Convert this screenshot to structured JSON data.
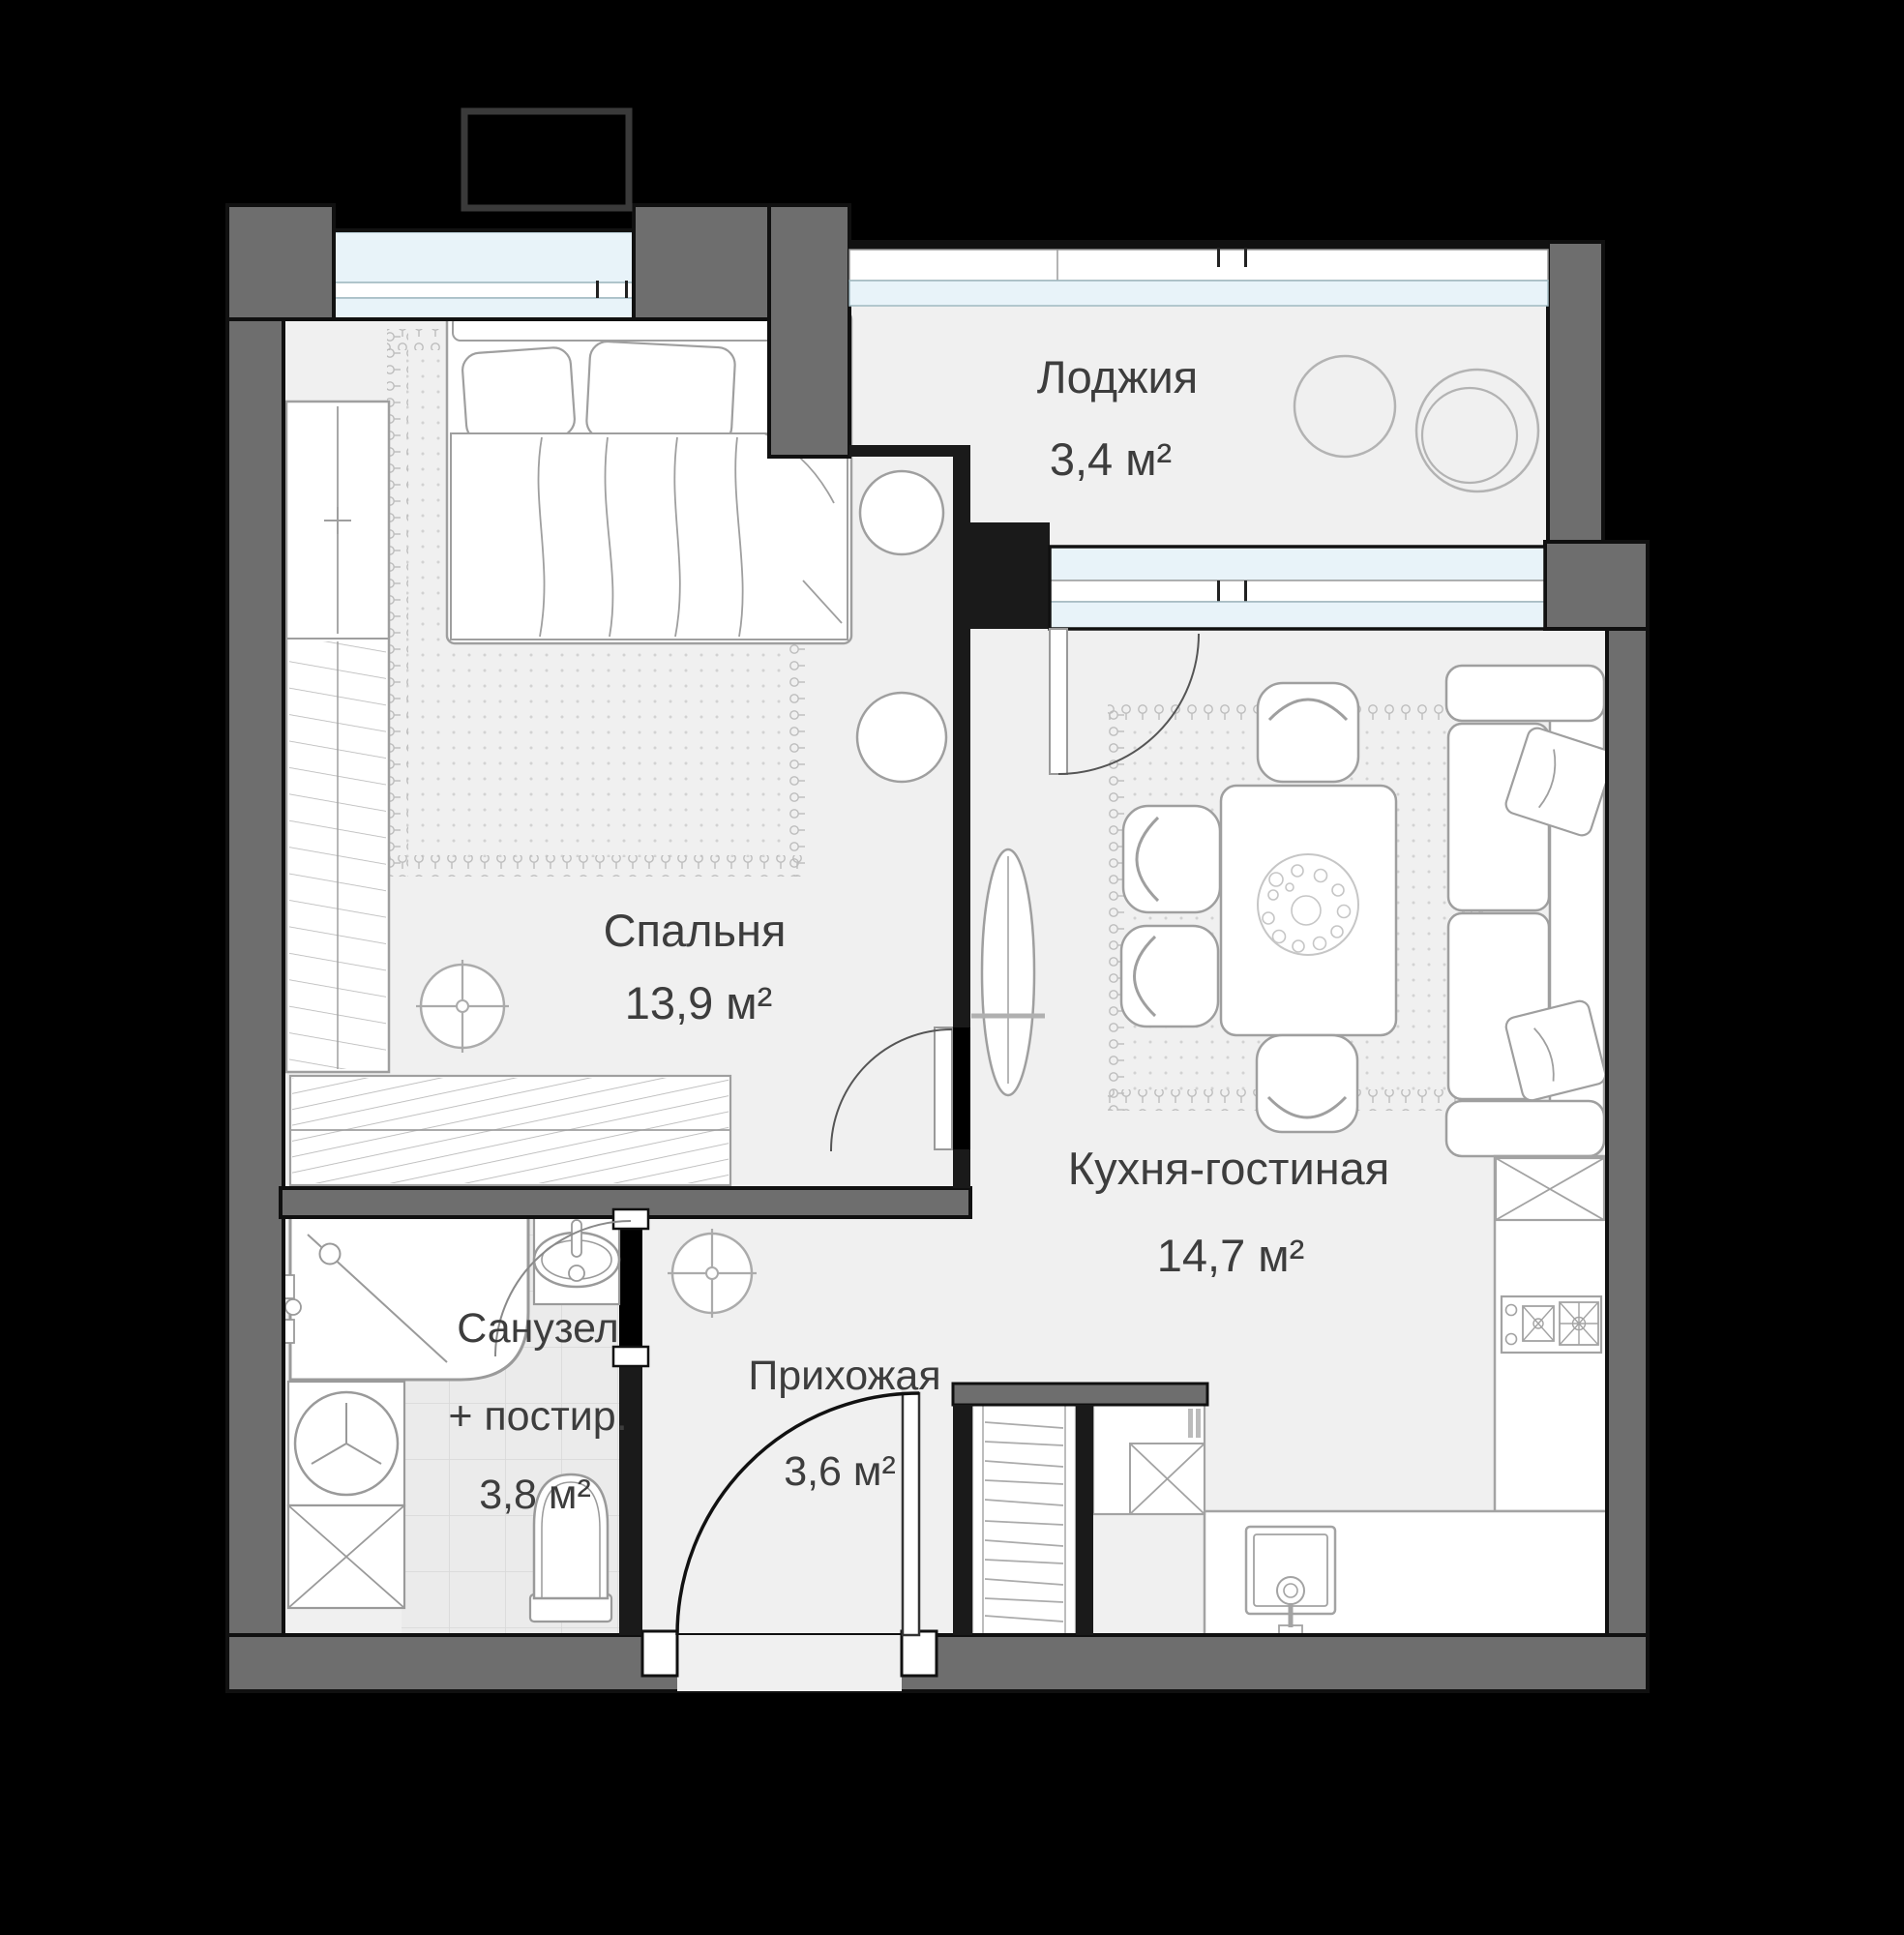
{
  "rooms": [
    {
      "name": "Спальня",
      "area": "13,9 м²"
    },
    {
      "name": "Лоджия",
      "area": "3,4 м²"
    },
    {
      "name": "Кухня-гостиная",
      "area": "14,7 м²"
    },
    {
      "name": "Санузел",
      "name2": "+ постир.",
      "area": "3,8 м²"
    },
    {
      "name": "Прихожая",
      "area": "3,6 м²"
    }
  ],
  "colors": {
    "background": "#000000",
    "wall": "#6e6e6e",
    "partition": "#1a1a1a",
    "floor": "#f0f0f0",
    "tile": "#ebebeb",
    "glazing": "#e8f3f9",
    "furniture_stroke": "#9f9f9f",
    "text": "#3d3d3d"
  }
}
